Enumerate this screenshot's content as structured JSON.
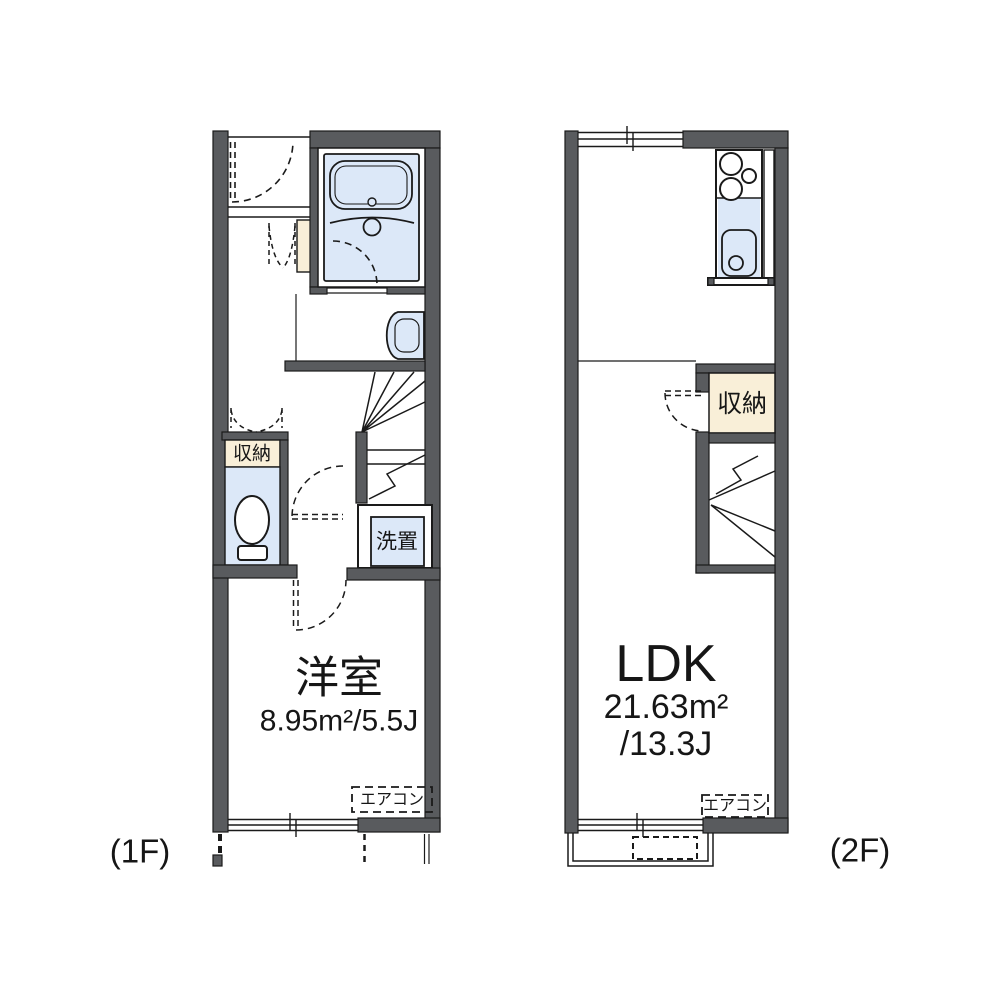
{
  "colors": {
    "wall_gray": "#595b5e",
    "fixture_blue": "#dce8f8",
    "storage_beige": "#f9efd8",
    "line": "#1a1a1a",
    "background": "#ffffff"
  },
  "floor_1f": {
    "floor_label": "(1F)",
    "room_name": "洋室",
    "room_area": "8.95m²/5.5J",
    "storage_label": "収納",
    "laundry_label": "洗置",
    "aircon_label": "エアコン"
  },
  "floor_2f": {
    "floor_label": "(2F)",
    "room_name": "LDK",
    "room_area_line1": "21.63m²",
    "room_area_line2": "/13.3J",
    "storage_label": "収納",
    "aircon_label": "エアコン"
  }
}
